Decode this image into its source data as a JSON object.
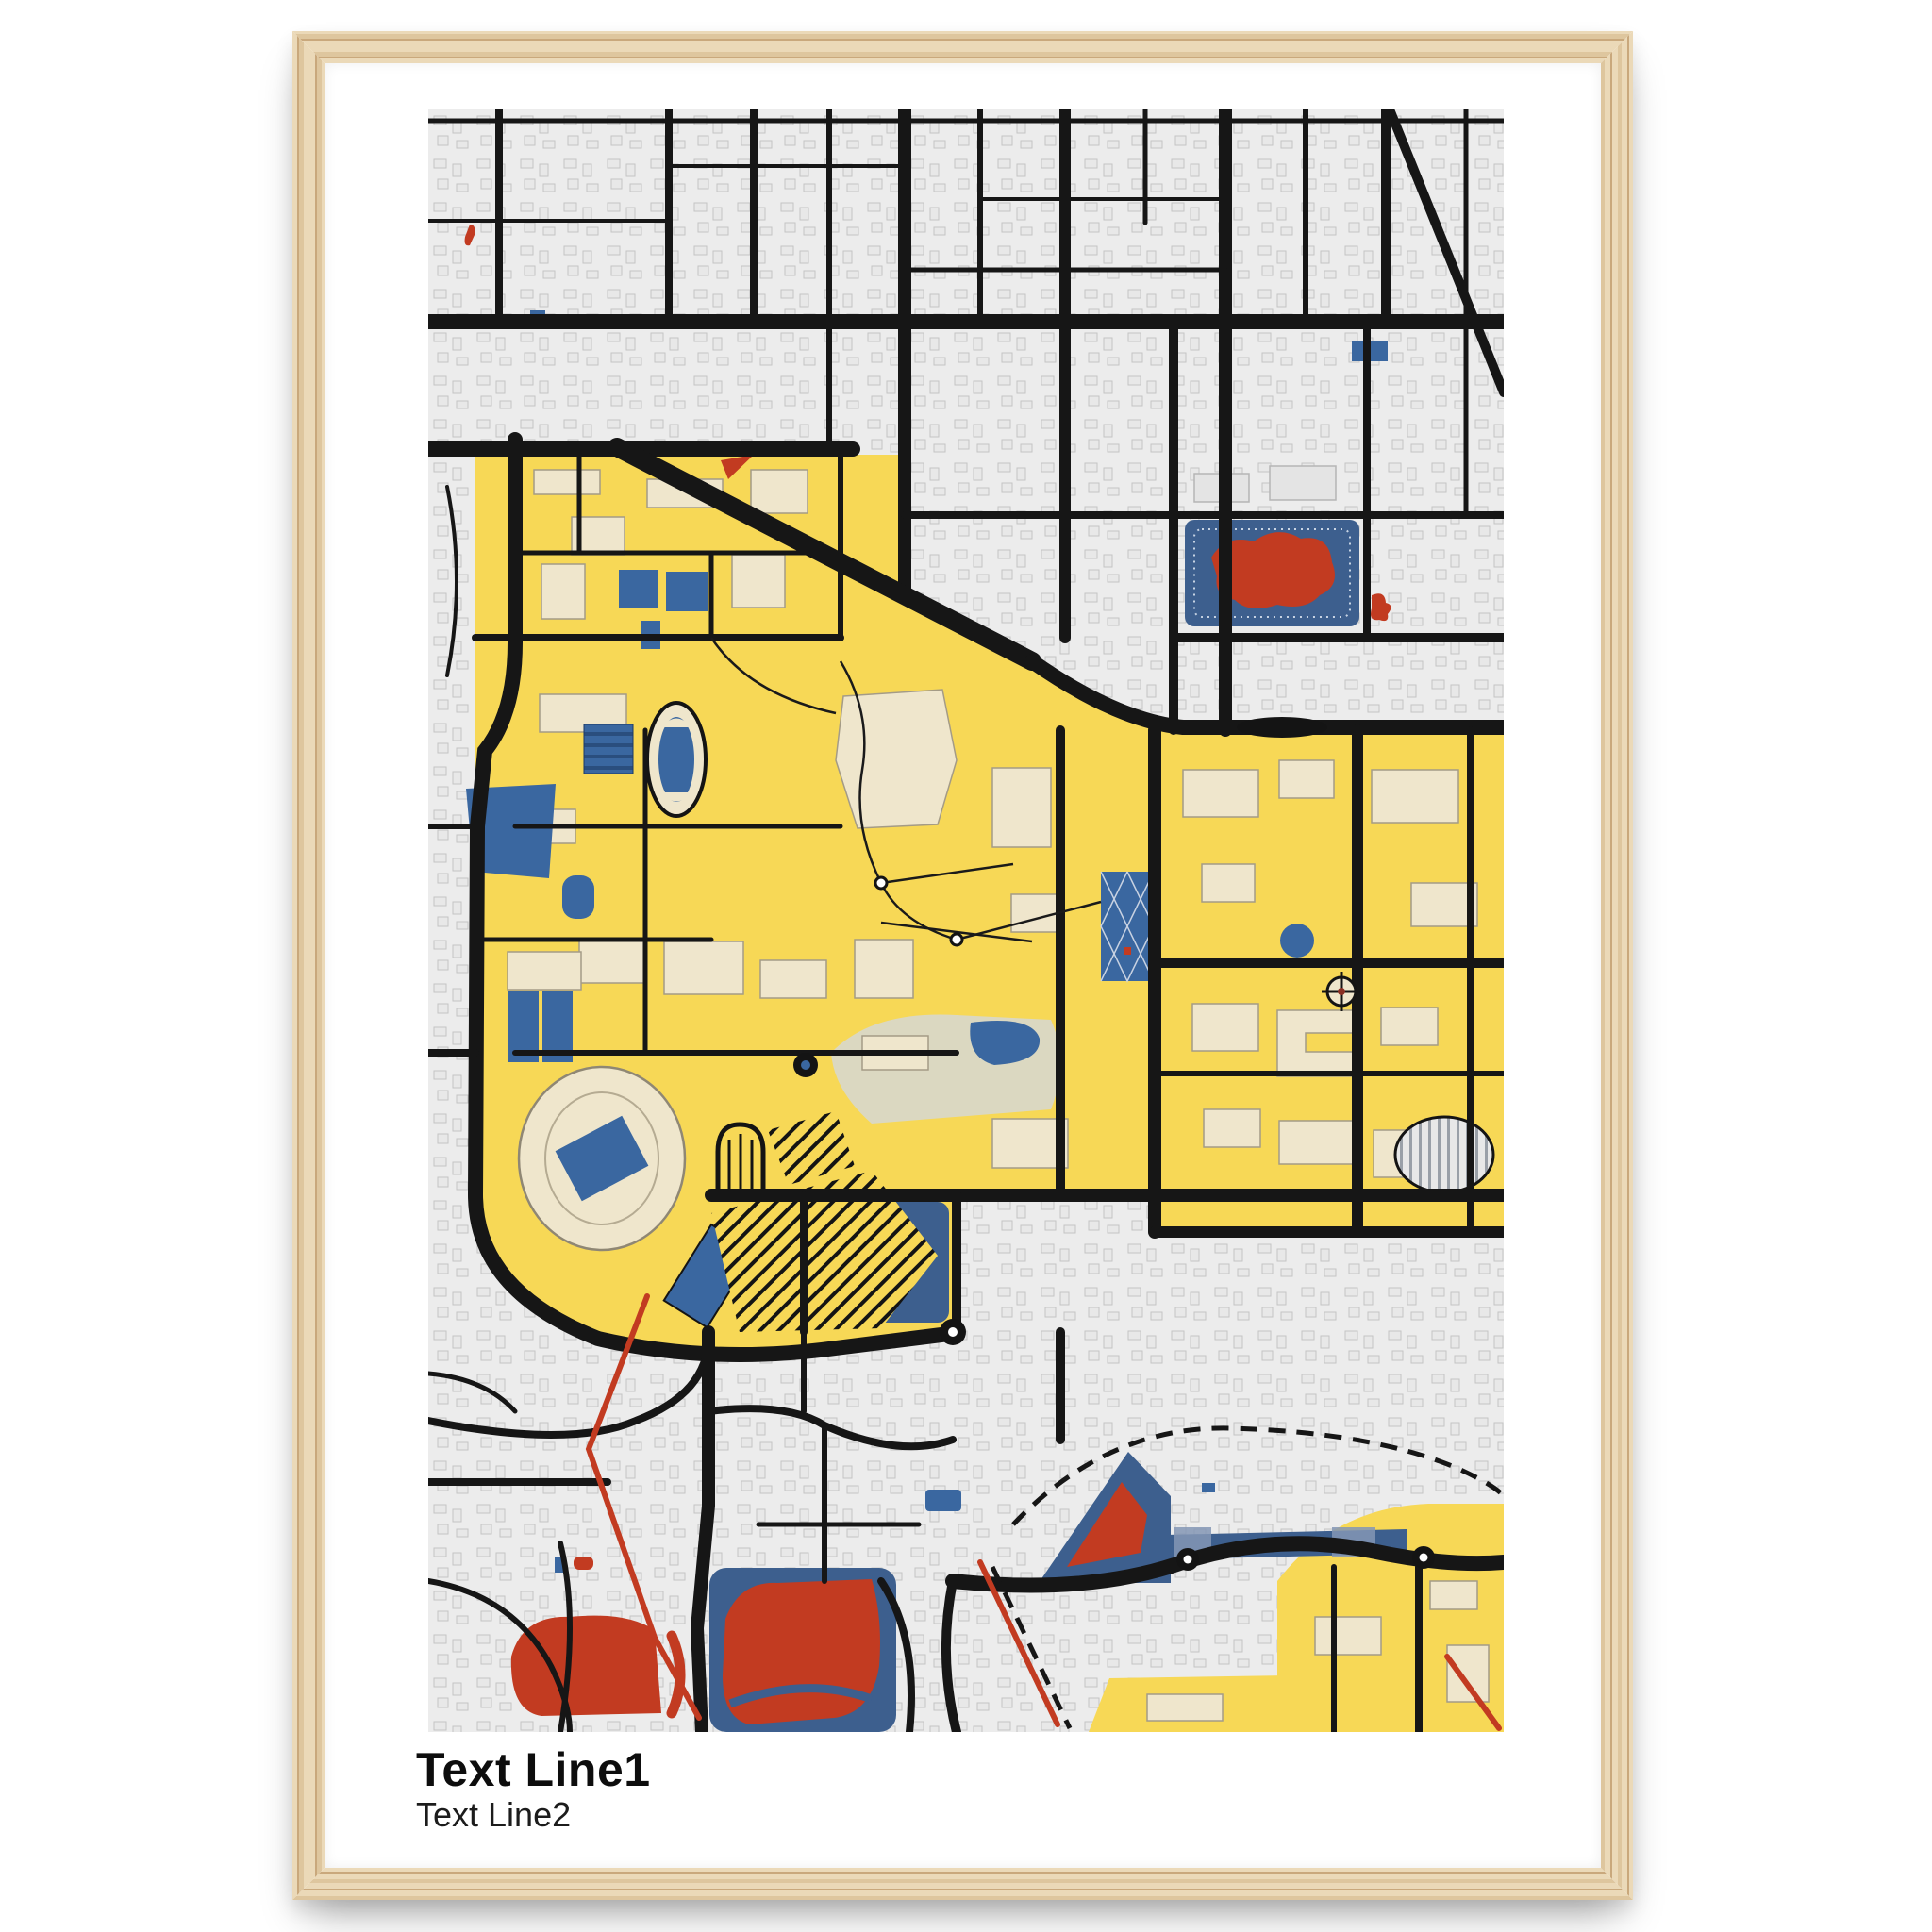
{
  "caption": {
    "line1": "Text Line1",
    "line2": "Text Line2"
  },
  "colors": {
    "frame_wood_light": "#EBD9B8",
    "frame_wood_mid": "#DEC69E",
    "frame_wood_dark": "#C9A87C",
    "poster_white": "#FFFFFF",
    "map_gray": "#ECECEC",
    "campus_yellow": "#F7D856",
    "water_blue": "#3A67A0",
    "lake_blue": "#3D5F8E",
    "accent_red": "#C23B21",
    "building_beige": "#EFE6CC",
    "road_black": "#161616"
  }
}
